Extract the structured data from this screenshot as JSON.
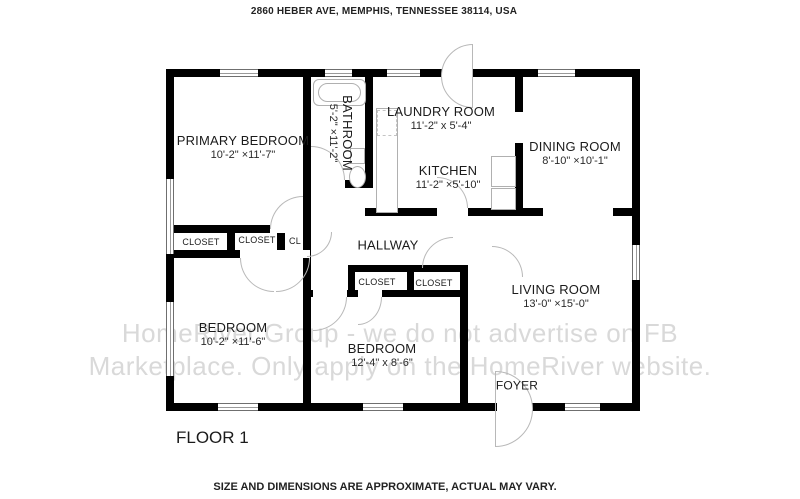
{
  "header": {
    "address": "2860 HEBER AVE, MEMPHIS, TENNESSEE 38114, USA"
  },
  "plan": {
    "floor_label": "FLOOR 1",
    "rooms": {
      "primary_bedroom": {
        "name": "PRIMARY BEDROOM",
        "dims": "10'-2\" ×11'-7\""
      },
      "bathroom": {
        "name": "BATHROOM",
        "dims": "5'-2\" ×11'-2\""
      },
      "laundry_room": {
        "name": "LAUNDRY ROOM",
        "dims": "11'-2\" x 5'-4\""
      },
      "kitchen": {
        "name": "KITCHEN",
        "dims": "11'-2\" ×5'-10\""
      },
      "dining_room": {
        "name": "DINING ROOM",
        "dims": "8'-10\" ×10'-1\""
      },
      "hallway": {
        "name": "HALLWAY"
      },
      "living_room": {
        "name": "LIVING ROOM",
        "dims": "13'-0\" ×15'-0\""
      },
      "foyer": {
        "name": "FOYER"
      },
      "bedroom_left": {
        "name": "BEDROOM",
        "dims": "10'-2\" ×11'-6\""
      },
      "bedroom_middle": {
        "name": "BEDROOM",
        "dims": "12'-4\" x 8'-6\""
      },
      "closet_a": {
        "name": "CLOSET"
      },
      "closet_b": {
        "name": "CLOSET"
      },
      "closet_c": {
        "name": "CL"
      },
      "closet_d": {
        "name": "CLOSET"
      },
      "closet_e": {
        "name": "CLOSET"
      }
    }
  },
  "watermark": {
    "line1": "HomeRiver Group - we do not advertise on FB",
    "line2": "Marketplace. Only apply on the HomeRiver website."
  },
  "footer": {
    "disclaimer": "SIZE AND DIMENSIONS ARE APPROXIMATE, ACTUAL MAY VARY."
  },
  "colors": {
    "wall": "#000000",
    "watermark": "#d9d9d9",
    "fixture_line": "#b8b8b8",
    "label_text": "#1b1b1b"
  }
}
